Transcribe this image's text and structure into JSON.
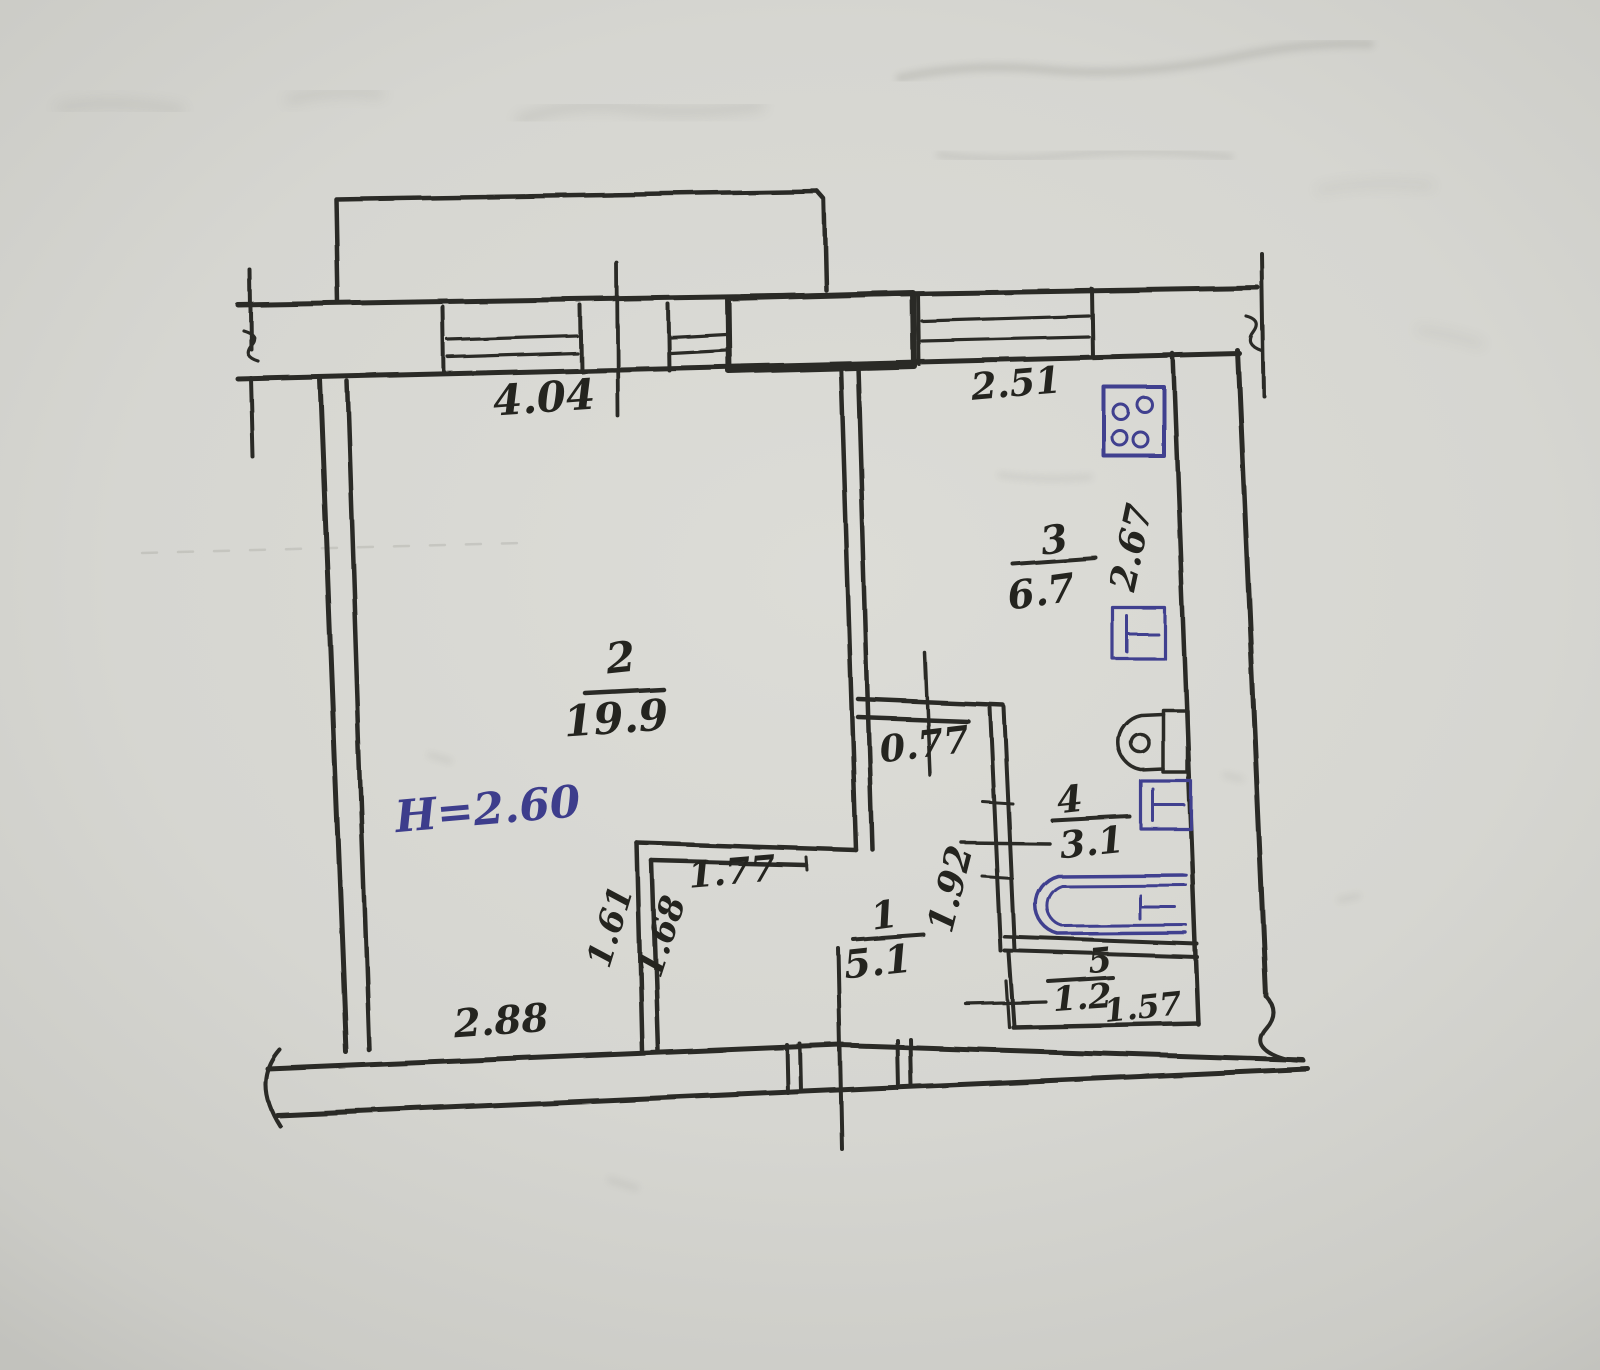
{
  "plan": {
    "ceiling_height_label": "H=2.60",
    "rooms": [
      {
        "key": "hallway",
        "number": "1",
        "area": "5.1"
      },
      {
        "key": "living-room",
        "number": "2",
        "area": "19.9"
      },
      {
        "key": "kitchen",
        "number": "3",
        "area": "6.7"
      },
      {
        "key": "bathroom",
        "number": "4",
        "area": "3.1"
      },
      {
        "key": "closet",
        "number": "5",
        "area": "1.2"
      }
    ],
    "dimensions": {
      "living_window_wall": "4.04",
      "kitchen_window_wall": "2.51",
      "kitchen_depth": "2.67",
      "kitchen_doorway": "0.77",
      "hall_depth": "1.92",
      "niche_width": "1.77",
      "niche_left_side": "1.61",
      "niche_right_side": "1.68",
      "bottom_left_wall": "2.88",
      "closet_width": "1.57"
    },
    "icons": {
      "stove": "gas-stove-4-burners",
      "kitchen_sink": "sink",
      "toilet": "toilet",
      "washbasin": "washbasin",
      "bathtub": "bathtub"
    },
    "colors": {
      "ink": "#2b2b26",
      "blue_ink": "#41418f",
      "paper": "#d6d6d1"
    }
  }
}
